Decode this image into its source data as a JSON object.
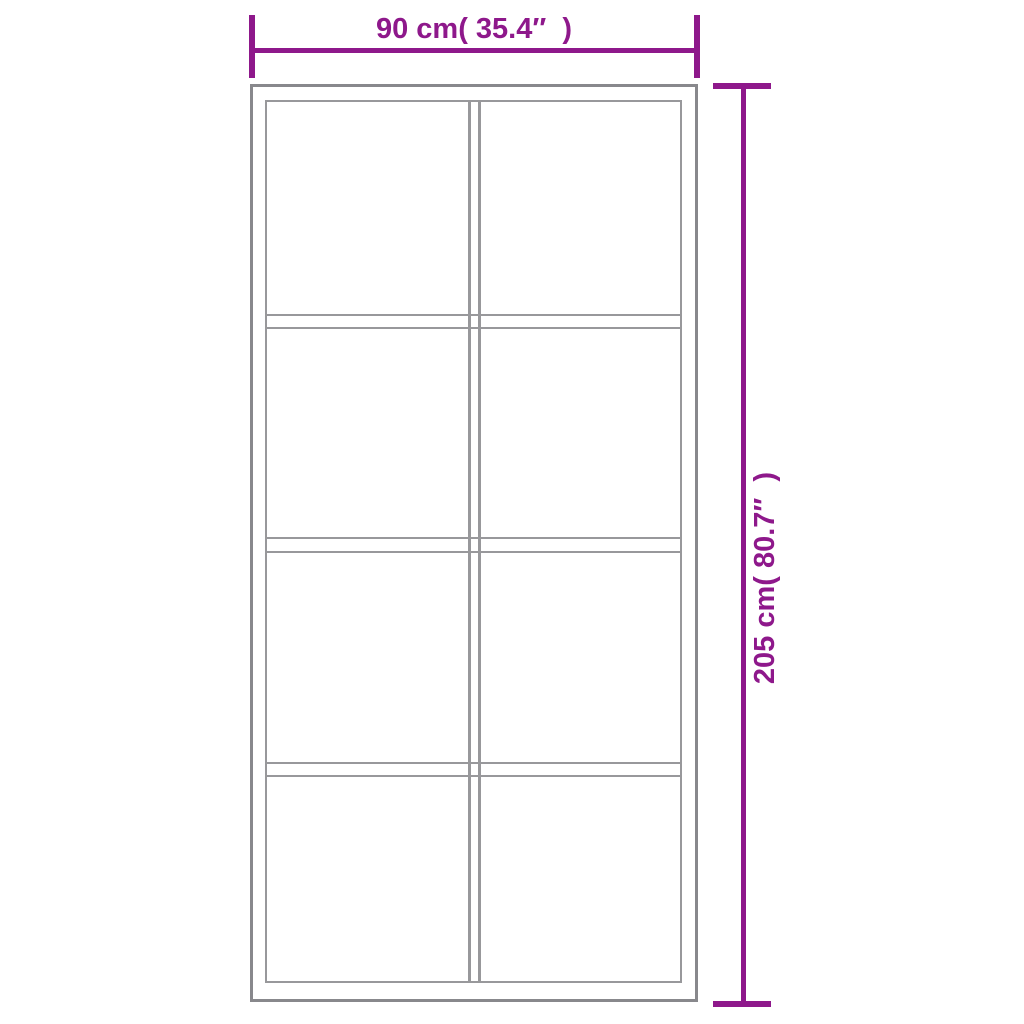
{
  "diagram": {
    "kind": "product-dimension-diagram",
    "subject": "door with glass panels",
    "panels": {
      "columns": 2,
      "rows": 4,
      "count": 8
    },
    "dimensions": {
      "width": {
        "label": "90 cm( 35.4″  )",
        "value_cm": 90,
        "value_inch": 35.4
      },
      "height": {
        "label": "205 cm( 80.7″  )",
        "value_cm": 205,
        "value_inch": 80.7
      }
    },
    "colors": {
      "dimension_accent": "#8e188b",
      "door_outline": "#88888c",
      "panel_outline": "#98989b",
      "background": "#ffffff"
    }
  }
}
